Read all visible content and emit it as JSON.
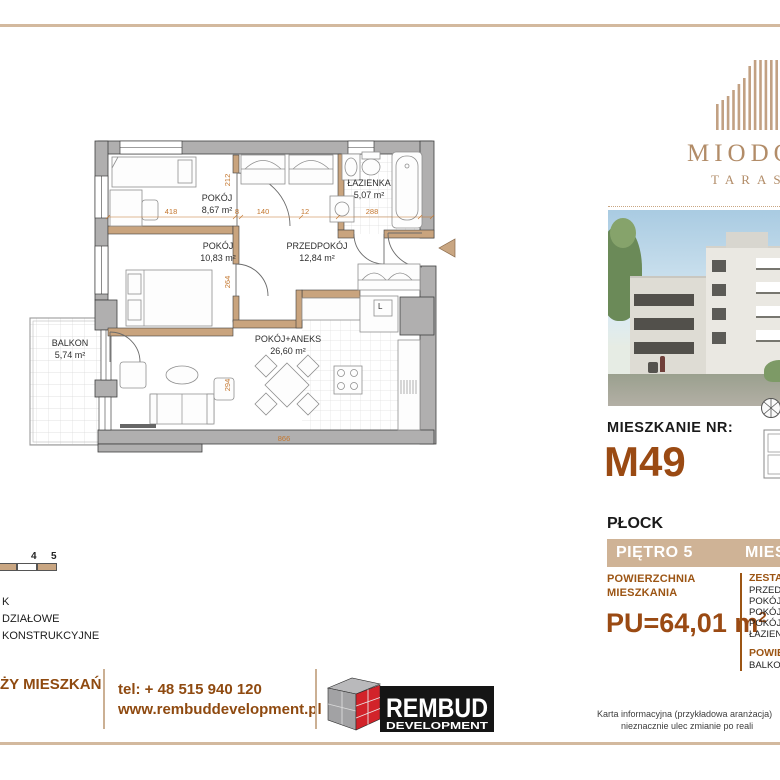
{
  "brand": {
    "name_top": "MIODO",
    "name_bottom": "TARAS"
  },
  "plan": {
    "rooms": [
      {
        "name": "POKÓJ",
        "area": "8,67 m²"
      },
      {
        "name": "POKÓJ",
        "area": "10,83 m²"
      },
      {
        "name": "PRZEDPOKÓJ",
        "area": "12,84 m²"
      },
      {
        "name": "ŁAZIENKA",
        "area": "5,07 m²"
      },
      {
        "name": "POKÓJ+ANEKS",
        "area": "26,60 m²"
      },
      {
        "name": "BALKON",
        "area": "5,74 m²"
      }
    ],
    "fridge_label": "L",
    "dims": {
      "d418": "418",
      "d212": "212",
      "d8": "8",
      "d140": "140",
      "d12": "12",
      "d288": "288",
      "d264": "264",
      "d294": "294",
      "d866": "866"
    }
  },
  "info": {
    "apartment_label": "MIESZKANIE NR:",
    "apartment_no": "M49",
    "city": "PŁOCK",
    "floor": "PIĘTRO 5",
    "bar_right_fragment": "MIES",
    "area_label_line1": "POWIERZCHNIA",
    "area_label_line2": "MIESZKANIA",
    "area_value": "PU=64,01 m",
    "area_value_sup": "2",
    "rooms_list": {
      "header_fragment": "ZESTA",
      "items": [
        "PRZED",
        "POKÓJ",
        "POKÓJ",
        "POKÓJ",
        "ŁAZIEN"
      ],
      "sub_header_fragment": "POWIE",
      "sub_item_fragment": "BALKO"
    }
  },
  "legend": {
    "scale_ticks": [
      "4",
      "5"
    ],
    "lines": [
      "K",
      "DZIAŁOWE",
      "KONSTRUKCYJNE"
    ]
  },
  "footer": {
    "left_fragment": "ŻY MIESZKAŃ",
    "tel": "tel: + 48 515 940 120",
    "www": "www.rembuddevelopment.pl",
    "logo_line1": "REMBUD",
    "logo_line2": "DEVELOPMENT"
  },
  "fineprint": {
    "line1": "Karta informacyjna (przykładowa aranżacja)",
    "line2": "nieznacznie ulec zmianie po reali"
  },
  "colors": {
    "accent_tan": "#c9a682",
    "brand_brown": "#9c5514",
    "bar_beige": "#cfb396",
    "dim_orange": "#c4772f",
    "rembud_red": "#d2232a"
  }
}
